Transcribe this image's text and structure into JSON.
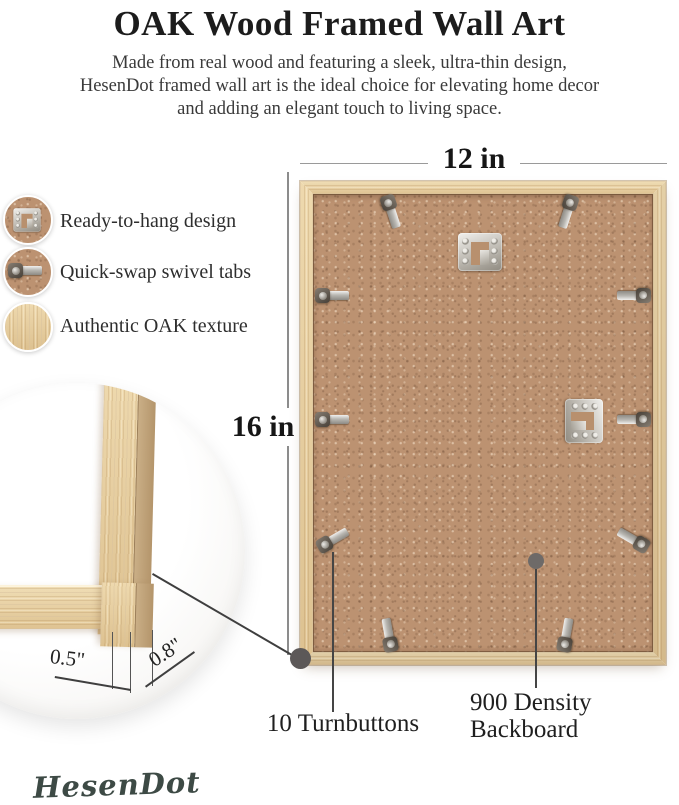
{
  "header": {
    "title": "OAK Wood Framed Wall Art",
    "subtitle_line1": "Made from real wood and featuring a sleek, ultra-thin design,",
    "subtitle_line2": "HesenDot framed wall art is the ideal choice for elevating home decor",
    "subtitle_line3": "and adding an elegant touch to living space."
  },
  "features": [
    {
      "label": "Ready-to-hang design",
      "icon": "sawtooth-hanger-icon"
    },
    {
      "label": "Quick-swap swivel tabs",
      "icon": "turnbutton-icon"
    },
    {
      "label": "Authentic OAK texture",
      "icon": "oak-texture-icon"
    }
  ],
  "dimensions": {
    "width_label": "12 in",
    "height_label": "16 in",
    "face_width_label": "0.5\"",
    "depth_label": "0.8\""
  },
  "callouts": {
    "turnbuttons_label": "10 Turnbuttons",
    "backboard_line1": "900 Density",
    "backboard_line2": "Backboard"
  },
  "brand": {
    "logo_text": "HesenDot"
  },
  "colors": {
    "oak_wood": "#e4c795",
    "mdf_backboard": "#bc9271",
    "metal": "#c9c6c0",
    "text": "#1e1e1e",
    "logo": "#3d4a45"
  }
}
